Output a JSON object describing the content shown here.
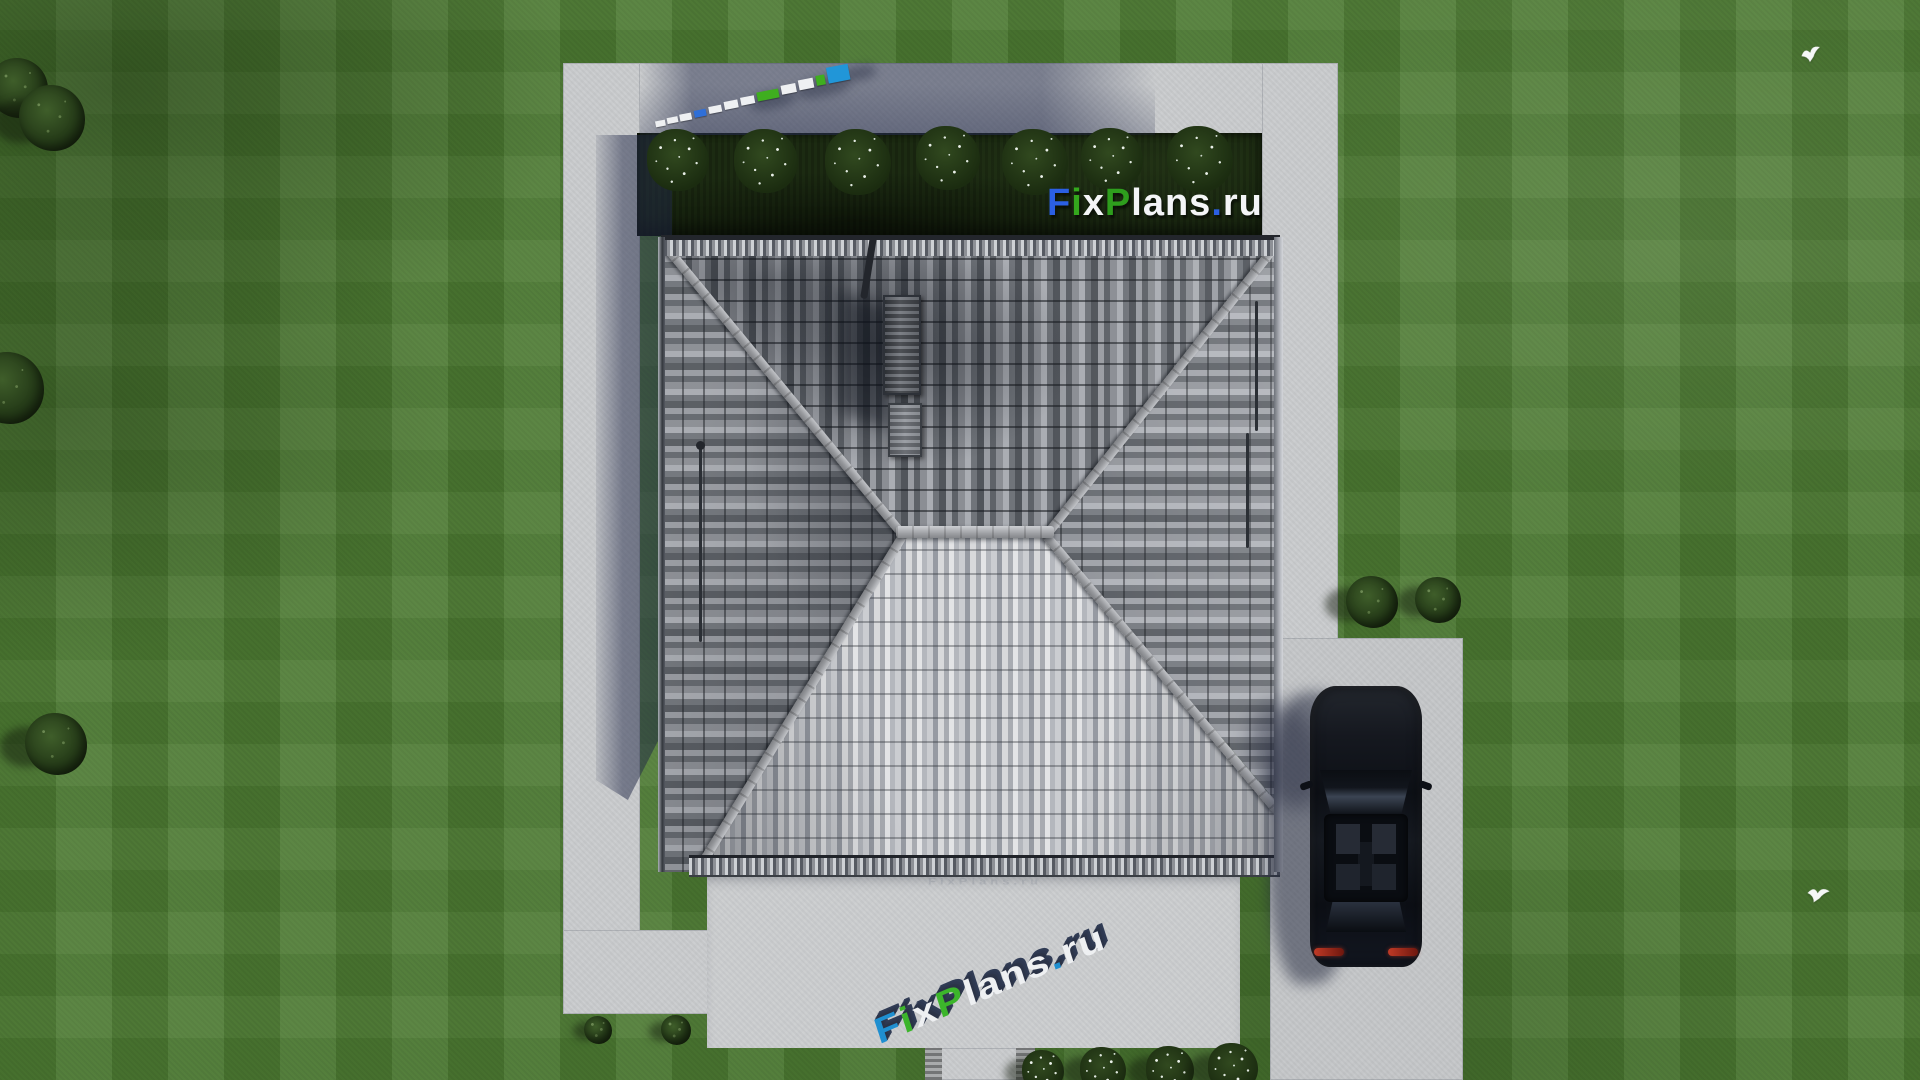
{
  "brand": {
    "text": "FixPlans.ru",
    "faint_text": "FixPlans.ru",
    "colors": {
      "blue": "#2b5fe3",
      "green": "#2e9e1d",
      "white": "#f4f5f7",
      "ground_blue": "#1f8fd0",
      "ground_green": "#3cb52b",
      "extrude_navy": "#2b3347"
    },
    "main_segments": [
      {
        "text": "F",
        "color": "#2b5fe3"
      },
      {
        "text": "i",
        "color": "#34a81d"
      },
      {
        "text": "x",
        "color": "#f4f5f7"
      },
      {
        "text": "P",
        "color": "#2e9e1d"
      },
      {
        "text": "lans",
        "color": "#f4f5f7"
      },
      {
        "text": ".",
        "color": "#2b5fe3"
      },
      {
        "text": "ru",
        "color": "#f4f5f7"
      }
    ],
    "ground_segments": [
      {
        "text": "F",
        "color": "#1f8fd0"
      },
      {
        "text": "i",
        "color": "#3cb52b"
      },
      {
        "text": "x",
        "color": "#eef0f2"
      },
      {
        "text": "P",
        "color": "#3cb52b"
      },
      {
        "text": "lans",
        "color": "#eef0f2"
      },
      {
        "text": ".",
        "color": "#1f8fd0"
      },
      {
        "text": "ru",
        "color": "#eef0f2"
      }
    ]
  },
  "palette": {
    "lawn": "#4e7c34",
    "concrete": "#c9cbcd",
    "hedge_bed": "#1c2b12",
    "roof_dark_tile": "#53575d",
    "roof_light_tile": "#aaadb3",
    "roof_south_tile": "#d8d9db",
    "ridge_cap": "#9fa1a5",
    "car_body": "#10141b",
    "taillight_red": "#c03a26",
    "shadow_blue": "#242b4a",
    "bird_white": "#f5f7f7",
    "flower_white": "#e9efe8"
  },
  "landscape": {
    "hedge_bushes": [
      {
        "x": 678,
        "y": 160,
        "r": 31
      },
      {
        "x": 766,
        "y": 161,
        "r": 32
      },
      {
        "x": 858,
        "y": 162,
        "r": 33
      },
      {
        "x": 948,
        "y": 158,
        "r": 32
      },
      {
        "x": 1035,
        "y": 162,
        "r": 33
      },
      {
        "x": 1112,
        "y": 159,
        "r": 31
      },
      {
        "x": 1200,
        "y": 159,
        "r": 33
      }
    ],
    "border_bushes": [
      {
        "x": 1043,
        "y": 1071,
        "r": 21
      },
      {
        "x": 1103,
        "y": 1070,
        "r": 23
      },
      {
        "x": 1170,
        "y": 1070,
        "r": 24
      },
      {
        "x": 1233,
        "y": 1068,
        "r": 25
      }
    ],
    "trees": [
      {
        "x": 18,
        "y": 88,
        "r": 30
      },
      {
        "x": 52,
        "y": 118,
        "r": 33
      },
      {
        "x": 8,
        "y": 388,
        "r": 36
      },
      {
        "x": 56,
        "y": 744,
        "r": 31
      }
    ],
    "shrubs_right": [
      {
        "x": 1372,
        "y": 602,
        "r": 26
      },
      {
        "x": 1438,
        "y": 600,
        "r": 23
      }
    ],
    "shrubs_small": [
      {
        "x": 598,
        "y": 1030,
        "r": 14
      },
      {
        "x": 676,
        "y": 1030,
        "r": 15
      }
    ],
    "birds": [
      {
        "x": 1798,
        "y": 44,
        "rot": -8,
        "size": 26
      },
      {
        "x": 1804,
        "y": 884,
        "rot": 14,
        "size": 28
      }
    ],
    "logo_strip_blocks": [
      {
        "x": 0,
        "y": 26,
        "w": 10,
        "h": 6,
        "color": "#eef0f2"
      },
      {
        "x": 12,
        "y": 25,
        "w": 11,
        "h": 6,
        "color": "#eef0f2"
      },
      {
        "x": 25,
        "y": 24,
        "w": 12,
        "h": 7,
        "color": "#eef0f2"
      },
      {
        "x": 40,
        "y": 23,
        "w": 12,
        "h": 7,
        "color": "#2f6fd8"
      },
      {
        "x": 55,
        "y": 22,
        "w": 13,
        "h": 7,
        "color": "#eef0f2"
      },
      {
        "x": 71,
        "y": 20,
        "w": 14,
        "h": 8,
        "color": "#eef0f2"
      },
      {
        "x": 88,
        "y": 19,
        "w": 14,
        "h": 8,
        "color": "#eef0f2"
      },
      {
        "x": 105,
        "y": 17,
        "w": 22,
        "h": 9,
        "color": "#3fae1f"
      },
      {
        "x": 130,
        "y": 15,
        "w": 15,
        "h": 9,
        "color": "#eef0f2"
      },
      {
        "x": 148,
        "y": 13,
        "w": 15,
        "h": 10,
        "color": "#eef0f2"
      },
      {
        "x": 166,
        "y": 12,
        "w": 9,
        "h": 10,
        "color": "#3fae1f"
      },
      {
        "x": 178,
        "y": 6,
        "w": 22,
        "h": 16,
        "color": "#2196d8"
      }
    ]
  }
}
